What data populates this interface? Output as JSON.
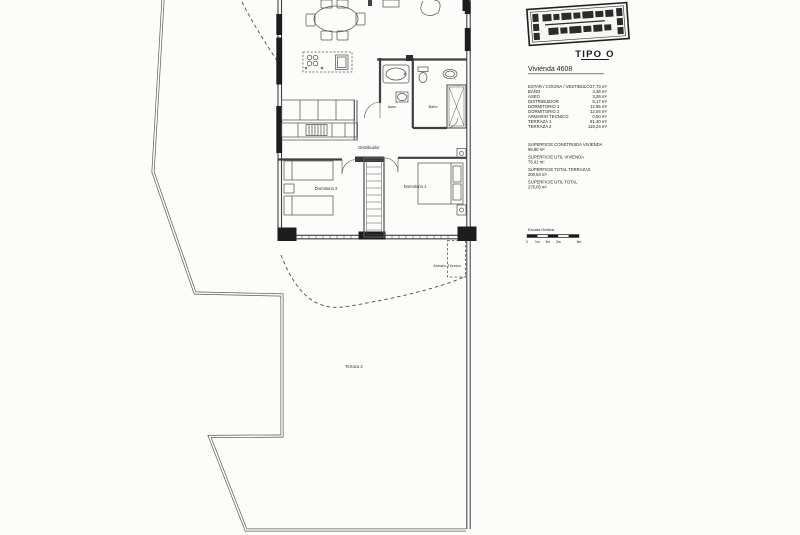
{
  "colors": {
    "paper": "#fcfcfa",
    "ink": "#3c3c3c",
    "window_fill": "#1d1d1d"
  },
  "titleblock": {
    "type_title": "TIPO O",
    "unit_title": "Vivienda 4608",
    "rooms": [
      {
        "label": "ESTAR / COCINA / VESTIBULO",
        "area": "27,73 m²"
      },
      {
        "label": "BAÑO",
        "area": "3,36 m²"
      },
      {
        "label": "ASEO",
        "area": "3,26 m²"
      },
      {
        "label": "DISTRIBUIDOR",
        "area": "5,17 m²"
      },
      {
        "label": "DORMITORIO 1",
        "area": "12,95 m²"
      },
      {
        "label": "DORMITORIO 2",
        "area": "12,04 m²"
      },
      {
        "label": "ARMARIO TECNICO",
        "area": "0,50 m²"
      },
      {
        "label": "TERRAZA 1",
        "area": "81,40 m²"
      },
      {
        "label": "TERRAZA 2",
        "area": "119,24 m²"
      }
    ],
    "totals": [
      {
        "label": "SUPERFICIE CONSTRUIDA VIVIENDA",
        "area": "98,90 m²"
      },
      {
        "label": "SUPERFICIE UTIL VIVIENDA",
        "area": "75,41 m²"
      },
      {
        "label": "SUPERFICIE TOTAL TERRAZAS",
        "area": "200,64 m²"
      },
      {
        "label": "SUPERFICIE UTIL TOTAL",
        "area": "276,05 m²"
      }
    ],
    "scale": {
      "label": "Escala Gráfica",
      "ticks": [
        "0",
        "1m",
        "2m",
        "3m",
        "5m"
      ]
    }
  },
  "plan": {
    "labels": {
      "aseo": "Aseo",
      "bano": "Baño",
      "distribuidor": "Distribuidor",
      "dormitorio1": "Dormitorio 1",
      "dormitorio2": "Dormitorio 2",
      "armario_tecnico": "Armario Técnico",
      "terraza2": "Terraza 2"
    }
  }
}
